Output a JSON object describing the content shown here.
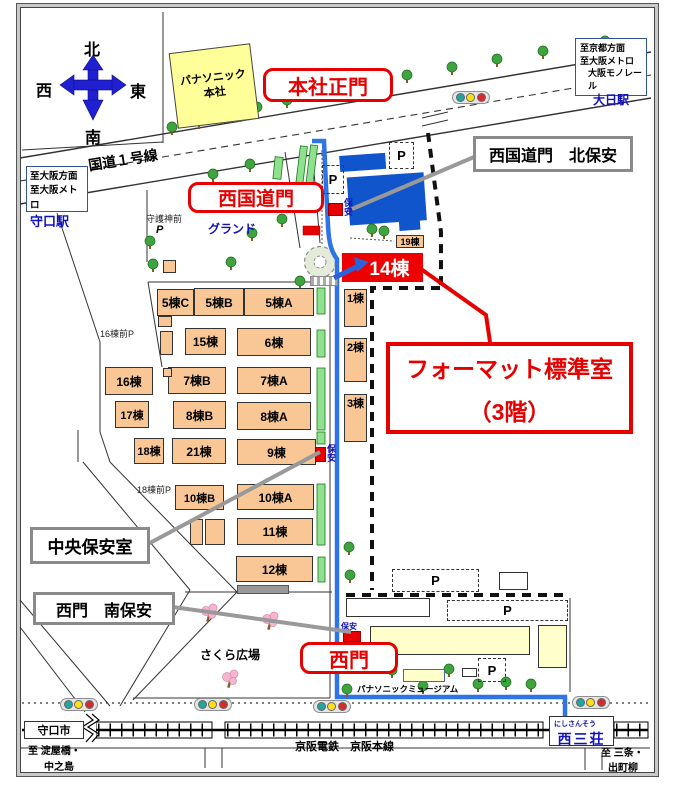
{
  "compass": {
    "n": "北",
    "s": "南",
    "e": "東",
    "w": "西"
  },
  "hq": {
    "name": "パナソニック 本社"
  },
  "gates": {
    "main": "本社正門",
    "west_kokudo": "西国道門",
    "west": "西門"
  },
  "security": {
    "north_label": "西国道門　北保安",
    "central_label": "中央保安室",
    "south_label": "西門　南保安",
    "marker": "保安"
  },
  "format_room": {
    "line1": "フォーマット標準室",
    "line2": "（3階）"
  },
  "roads": {
    "kokudo1": "国道１号線"
  },
  "areas": {
    "ground": "グランド",
    "sakura": "さくら広場",
    "shrine": "守護神前",
    "museum": "パナソニックミュージアム"
  },
  "left_box": {
    "line1": "至大阪方面",
    "line2": "至大阪メトロ",
    "station": "守口駅"
  },
  "right_box": {
    "line1": "至京都方面",
    "line2": "至大阪メトロ",
    "line3": "大阪モノレール",
    "station": "大日駅"
  },
  "rail": {
    "line_name": "京阪電鉄　京阪本線",
    "city": "守口市",
    "to_left1": "至 淀屋橋・",
    "to_left2": "中之島",
    "to_right1": "至 三条・",
    "to_right2": "出町柳",
    "station_kana": "にしさんそう",
    "station": "西三荘"
  },
  "parking": {
    "p": "P",
    "p16": "16棟前P",
    "p18": "18棟前P"
  },
  "buildings": [
    {
      "label": "5棟C"
    },
    {
      "label": "5棟B"
    },
    {
      "label": "5棟A"
    },
    {
      "label": "15棟"
    },
    {
      "label": "6棟"
    },
    {
      "label": "16棟"
    },
    {
      "label": "7棟B"
    },
    {
      "label": "7棟A"
    },
    {
      "label": "17棟"
    },
    {
      "label": "8棟B"
    },
    {
      "label": "8棟A"
    },
    {
      "label": "18棟"
    },
    {
      "label": "21棟"
    },
    {
      "label": "9棟"
    },
    {
      "label": "10棟B"
    },
    {
      "label": "10棟A"
    },
    {
      "label": "11棟"
    },
    {
      "label": "12棟"
    },
    {
      "label": "1棟"
    },
    {
      "label": "2棟"
    },
    {
      "label": "3棟"
    },
    {
      "label": "19棟"
    },
    {
      "label": "14棟"
    }
  ],
  "colors": {
    "gate_red": "#E60000",
    "route_blue": "#2E74E8",
    "building_orange": "#F9C795",
    "facility_blue": "#1155CC",
    "hq_yellow": "#FFFF99",
    "bldg_cream": "#FFFFCC",
    "hedge_green": "#8FE08F",
    "signal_teal": "#1FA79E",
    "signal_yellow": "#FFE11A",
    "signal_red": "#D62B2B",
    "station_blue": "#2F5597",
    "label_gray": "#8A8A8A"
  }
}
